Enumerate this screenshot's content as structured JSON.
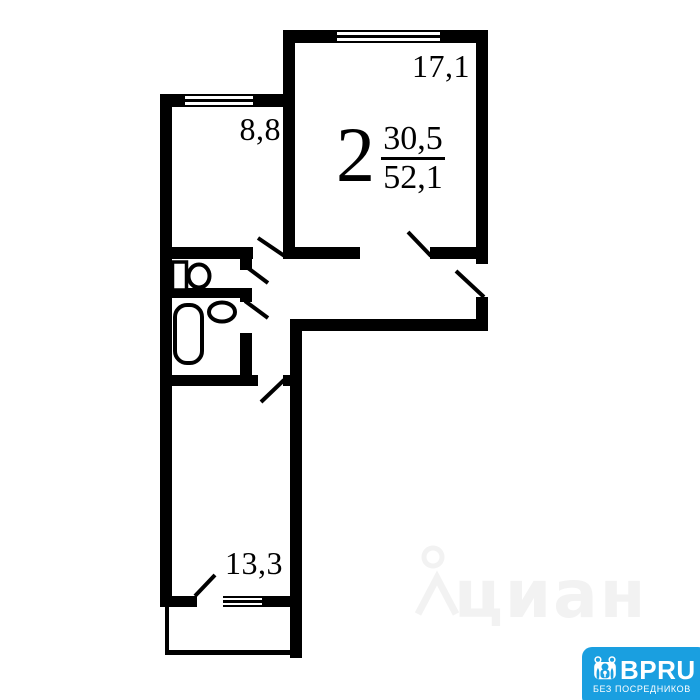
{
  "plan": {
    "type": "apartment-floor-plan",
    "summary": {
      "rooms_count": "2",
      "living_area": "30,5",
      "total_area": "52,1"
    },
    "rooms": [
      {
        "name": "room-large",
        "area": "17,1"
      },
      {
        "name": "room-small",
        "area": "8,8"
      },
      {
        "name": "room-bottom",
        "area": "13,3"
      }
    ]
  },
  "watermark": {
    "text": "циан",
    "color": "#f2f2f2"
  },
  "badge": {
    "brand": "BPRU",
    "tagline": "БЕЗ ПОСРЕДНИКОВ",
    "bg_color": "#1a9fe0",
    "text_color": "#ffffff"
  },
  "colors": {
    "wall": "#000000",
    "background": "#ffffff"
  }
}
